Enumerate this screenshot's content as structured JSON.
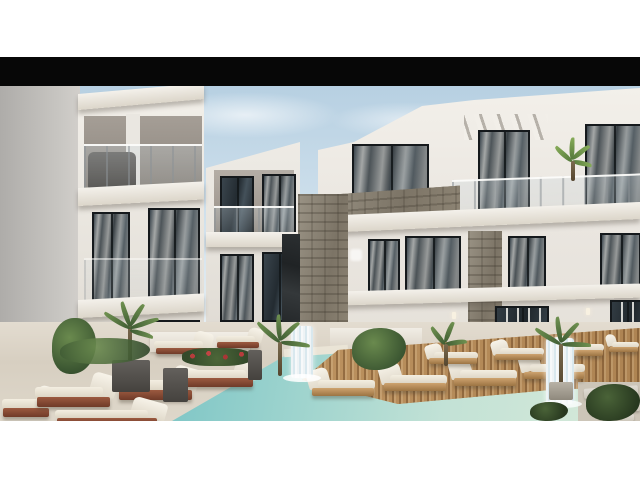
{
  "page": {
    "background": "#ffffff"
  },
  "letterbox": {
    "label": "black letterbox bar above photo",
    "color": "#070707"
  },
  "photo": {
    "label": "3D exterior rendering of a modern three-storey white resort apartment complex surrounding a courtyard swimming pool with a slatted wooden deck, rows of cushioned sun loungers, white water features and tropical plants",
    "sky_label": "pale blue sky with thin clouds",
    "left_wing_label": "left apartment wing with glass balcony railings, dark-framed windows and a grey outdoor sofa",
    "middle_block_label": "recessed middle apartment block with balconies",
    "right_wing_label": "main apartment building with stone-clad balcony parapet, white pergola fins and floor-to-ceiling windows",
    "stone_column_label": "natural stone clad column",
    "marble_column_label": "dark marble accent pillar",
    "pool_label": "turquoise swimming pool with pale sandy shallow end",
    "deck_label": "slatted wooden pool deck jutting into the pool",
    "loungers_left_label": "white sun loungers with red-brown wooden bases on the left terrace",
    "loungers_right_label": "white sun loungers with light wooden frames on the pool deck",
    "fountain_left_label": "white pillar fountain at pool edge",
    "fountain_right_label": "cascading white wall water feature",
    "planter_label": "white planter with red flowers",
    "pavers_label": "stone paver path in bottom right corner",
    "colors": {
      "sky_top": "#b7d0e2",
      "sky_bottom": "#eef2f2",
      "building_white": "#efece6",
      "building_shadow_wall": "#b3b1ae",
      "window_glass": "#2b343b",
      "window_frame": "#15191c",
      "curtain_white": "#f0eee8",
      "stone_cladding": "#8d8678",
      "dark_marble": "#26292c",
      "slab_greige": "#dcd6ca",
      "pool_deep": "#4fadb6",
      "pool_shallow": "#d8ead9",
      "deck_wood": "#c09663",
      "lounger_cushion": "#f3eee1",
      "lounger_wood_red": "#8a4f38",
      "plant_green": "#4a6338",
      "flower_red": "#b23c3c",
      "ground_travertine": "#d9d2c5",
      "letterbox_black": "#070707"
    }
  }
}
